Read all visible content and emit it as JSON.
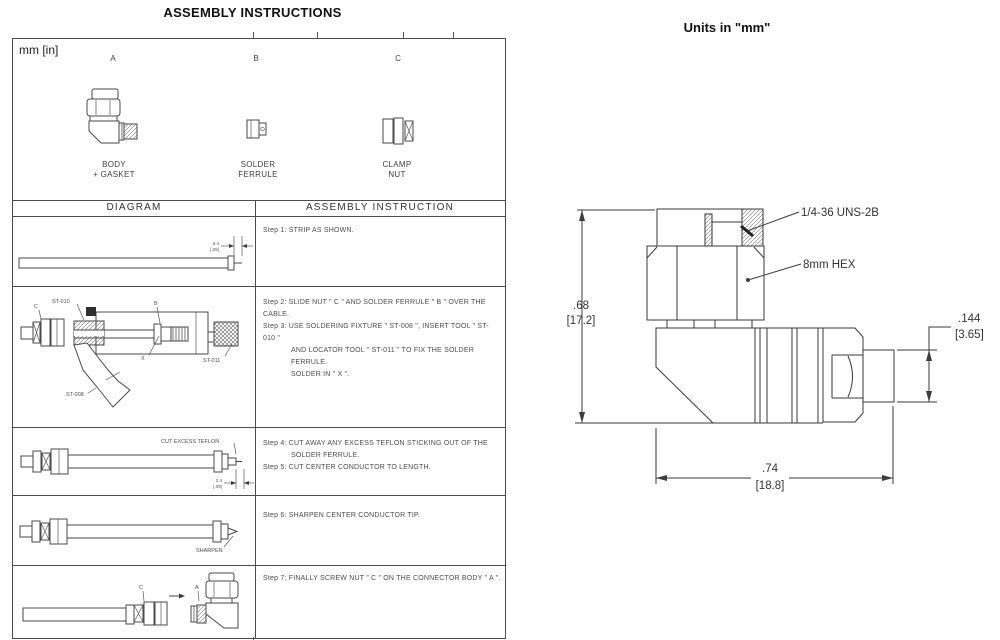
{
  "header": {
    "assembly_title": "ASSEMBLY INSTRUCTIONS",
    "units_note": "Units in \"mm\""
  },
  "parts": {
    "units_label": "mm [in]",
    "a_letter": "A",
    "b_letter": "B",
    "c_letter": "C",
    "a_name1": "BODY",
    "a_name2": "+ GASKET",
    "b_name1": "SOLDER",
    "b_name2": "FERRULE",
    "c_name1": "CLAMP",
    "c_name2": "NUT"
  },
  "table": {
    "diagram_header": "DIAGRAM",
    "instruction_header": "ASSEMBLY INSTRUCTION"
  },
  "steps": {
    "s1": "Step 1: STRIP AS SHOWN.",
    "s2": "Step 2: SLIDE NUT \" C \" AND SOLDER FERRULE \" B \" OVER THE CABLE.",
    "s3a": "Step 3: USE SOLDERING FIXTURE \" ST-008 \", INSERT TOOL \" ST-010 \"",
    "s3b": "AND LOCATOR TOOL \" ST-011 \" TO FIX THE SOLDER FERRULE.",
    "s3c": "SOLDER IN \" X \".",
    "s4a": "Step 4: CUT AWAY ANY EXCESS TEFLON STICKING OUT OF THE",
    "s4b": "SOLDER FERRULE.",
    "s5": "Step 5: CUT CENTER CONDUCTOR TO LENGTH.",
    "s6": "Step 6: SHARPEN CENTER CONDUCTOR TIP.",
    "s7": "Step 7: FINALLY SCREW NUT \" C \" ON THE CONNECTOR BODY \" A \"."
  },
  "labels": {
    "strip_dim_mm": "6.4",
    "strip_dim_in": "[.25]",
    "cut_dim_mm": "2.4",
    "cut_dim_in": "[.09]",
    "c": "C",
    "b": "B",
    "x": "X",
    "a": "A",
    "st008": "ST-008",
    "st010": "ST-010",
    "st011": "ST-011",
    "cut_teflon": "CUT EXCESS TEFLON",
    "sharpen": "SHARPEN"
  },
  "drawing": {
    "thread_label": "1/4-36 UNS-2B",
    "hex_label": "8mm HEX",
    "dim_height_in": ".68",
    "dim_height_mm": "[17.2]",
    "dim_length_in": ".74",
    "dim_length_mm": "[18.8]",
    "dim_pin_in": ".144",
    "dim_pin_mm": "[3.65]"
  }
}
